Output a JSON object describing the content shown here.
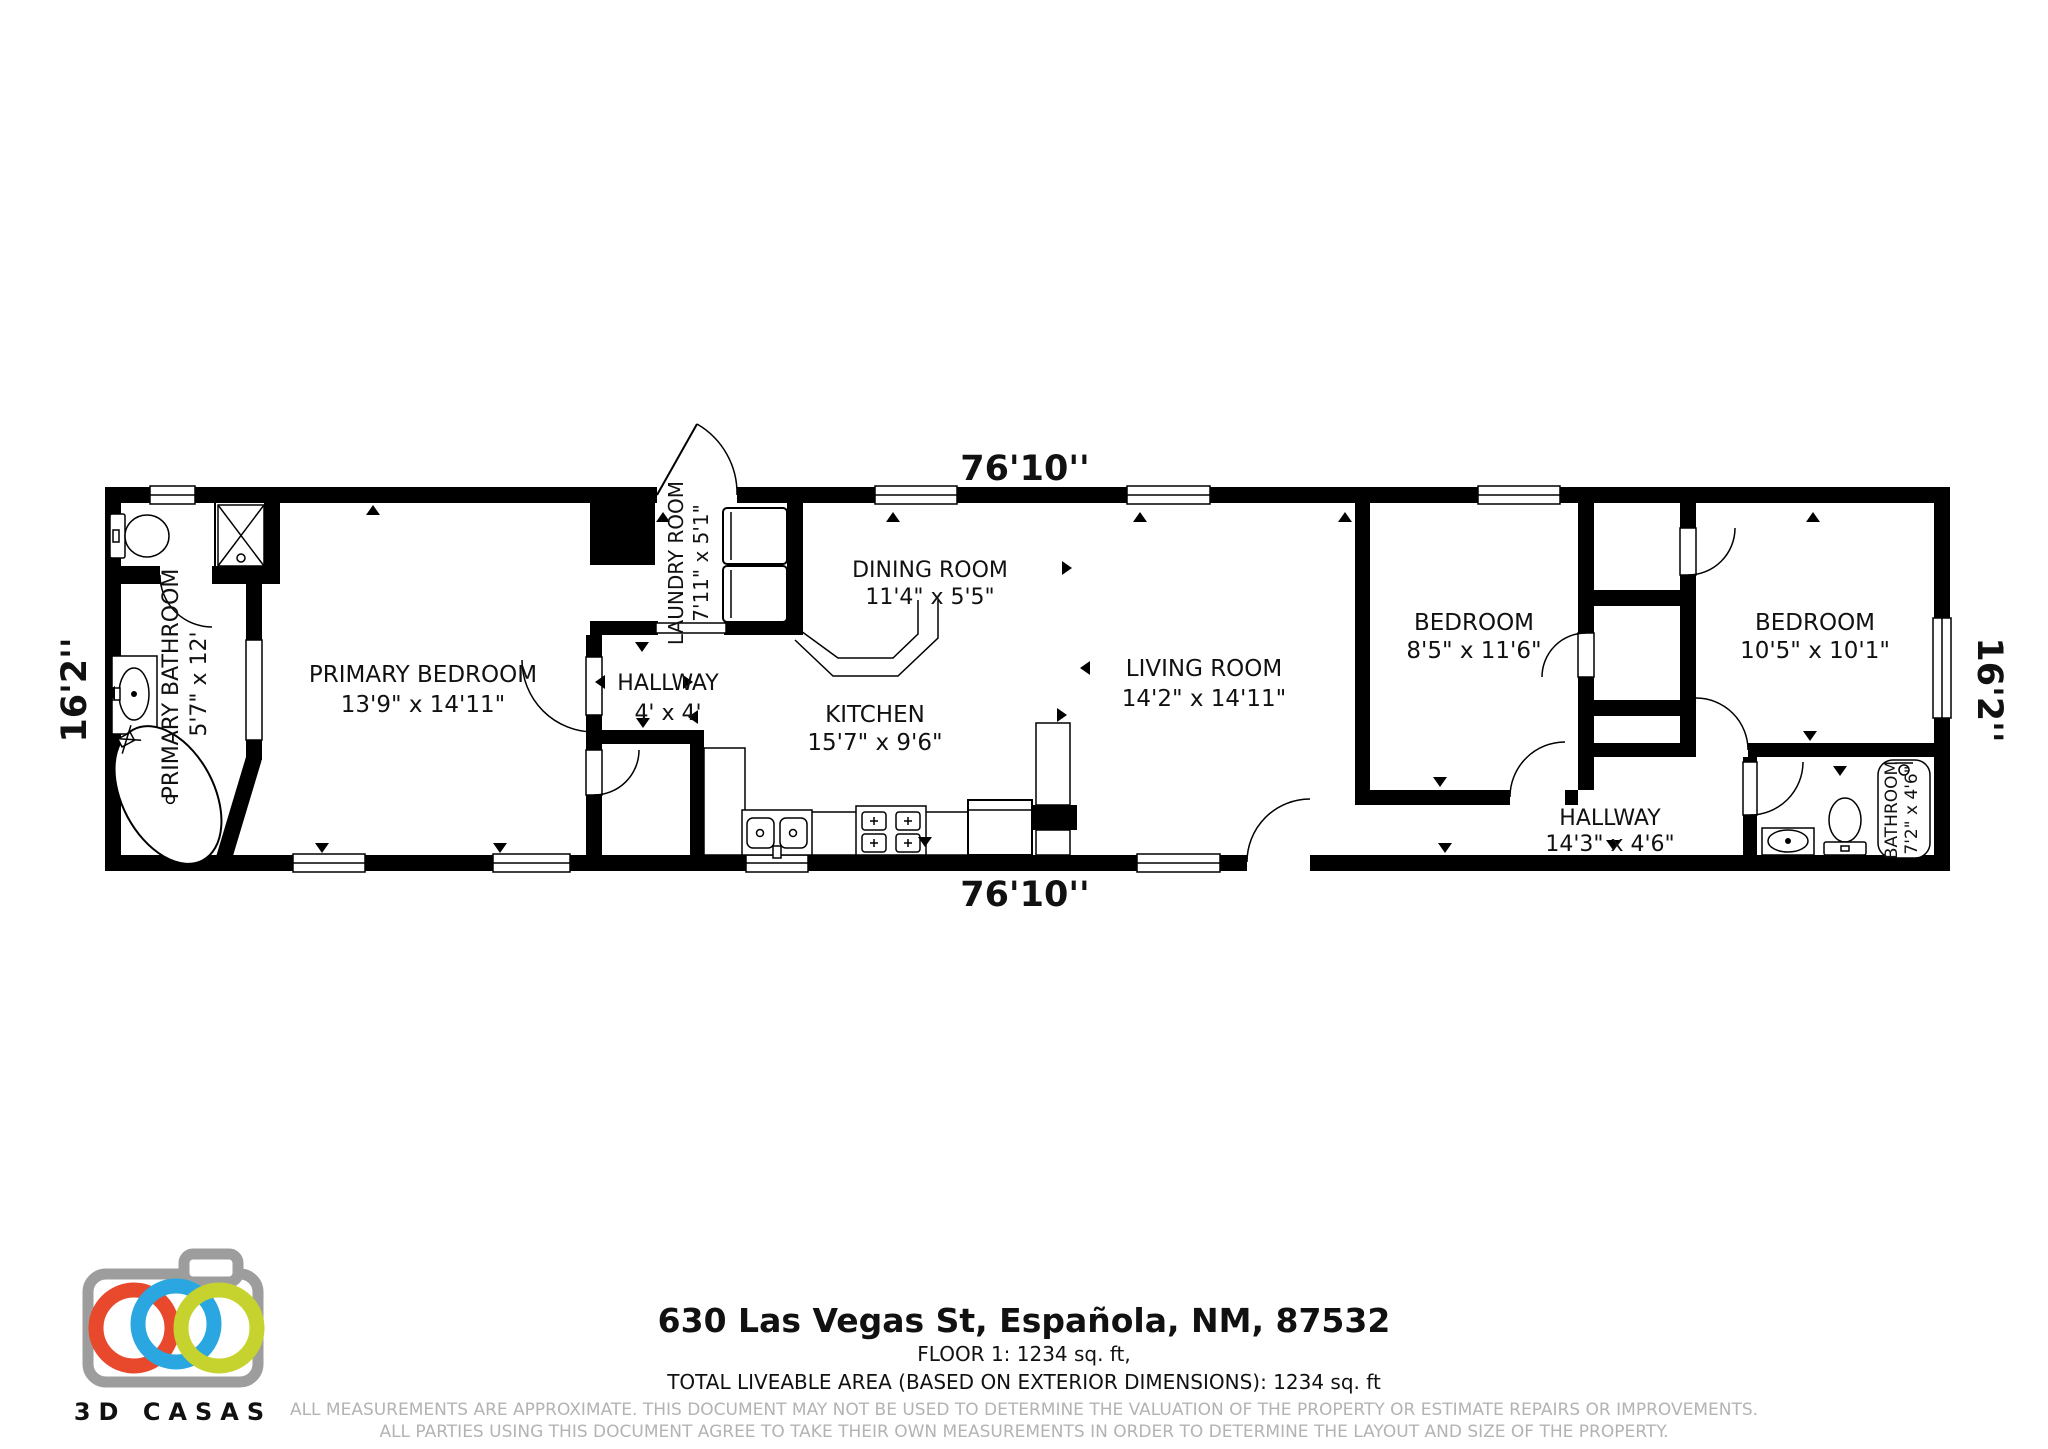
{
  "plan": {
    "dim_top": "76'10''",
    "dim_bottom": "76'10''",
    "dim_left": "16'2''",
    "dim_right": "16'2''",
    "rooms": {
      "primary_bathroom": {
        "name": "PRIMARY BATHROOM",
        "dims": "5'7\" x 12'"
      },
      "primary_bedroom": {
        "name": "PRIMARY BEDROOM",
        "dims": "13'9\" x 14'11\""
      },
      "laundry": {
        "name": "LAUNDRY ROOM",
        "dims": "7'11\" x 5'1\""
      },
      "hallway_center": {
        "name": "HALLWAY",
        "dims": "4' x 4'"
      },
      "dining": {
        "name": "DINING ROOM",
        "dims": "11'4\" x 5'5\""
      },
      "kitchen": {
        "name": "KITCHEN",
        "dims": "15'7\" x 9'6\""
      },
      "living": {
        "name": "LIVING ROOM",
        "dims": "14'2\" x 14'11\""
      },
      "bedroom_small": {
        "name": "BEDROOM",
        "dims": "8'5\" x 11'6\""
      },
      "bedroom_corner": {
        "name": "BEDROOM",
        "dims": "10'5\" x 10'1\""
      },
      "hallway_right": {
        "name": "HALLWAY",
        "dims": "14'3\" x 4'6\""
      },
      "bathroom": {
        "name": "BATHROOM",
        "dims": "7'2\" x 4'6\""
      }
    }
  },
  "footer": {
    "address": "630 Las Vegas St, Española, NM, 87532",
    "floor_line": "FLOOR 1: 1234 sq. ft,",
    "total_line": "TOTAL LIVEABLE AREA (BASED ON EXTERIOR DIMENSIONS): 1234 sq. ft",
    "disclaimer1": "ALL MEASUREMENTS ARE APPROXIMATE. THIS DOCUMENT MAY NOT BE USED TO DETERMINE THE VALUATION OF THE PROPERTY OR ESTIMATE REPAIRS OR IMPROVEMENTS.",
    "disclaimer2": "ALL PARTIES USING THIS DOCUMENT AGREE TO TAKE THEIR OWN MEASUREMENTS IN ORDER TO DETERMINE THE LAYOUT AND SIZE OF THE PROPERTY."
  },
  "logo": {
    "brand": "3D CASAS",
    "camera_gray": "#9d9d9d",
    "text_gray": "#9aa2a6",
    "ring_red": "#e8482b",
    "ring_blue": "#2aa7e0",
    "ring_green": "#c6d32e"
  }
}
